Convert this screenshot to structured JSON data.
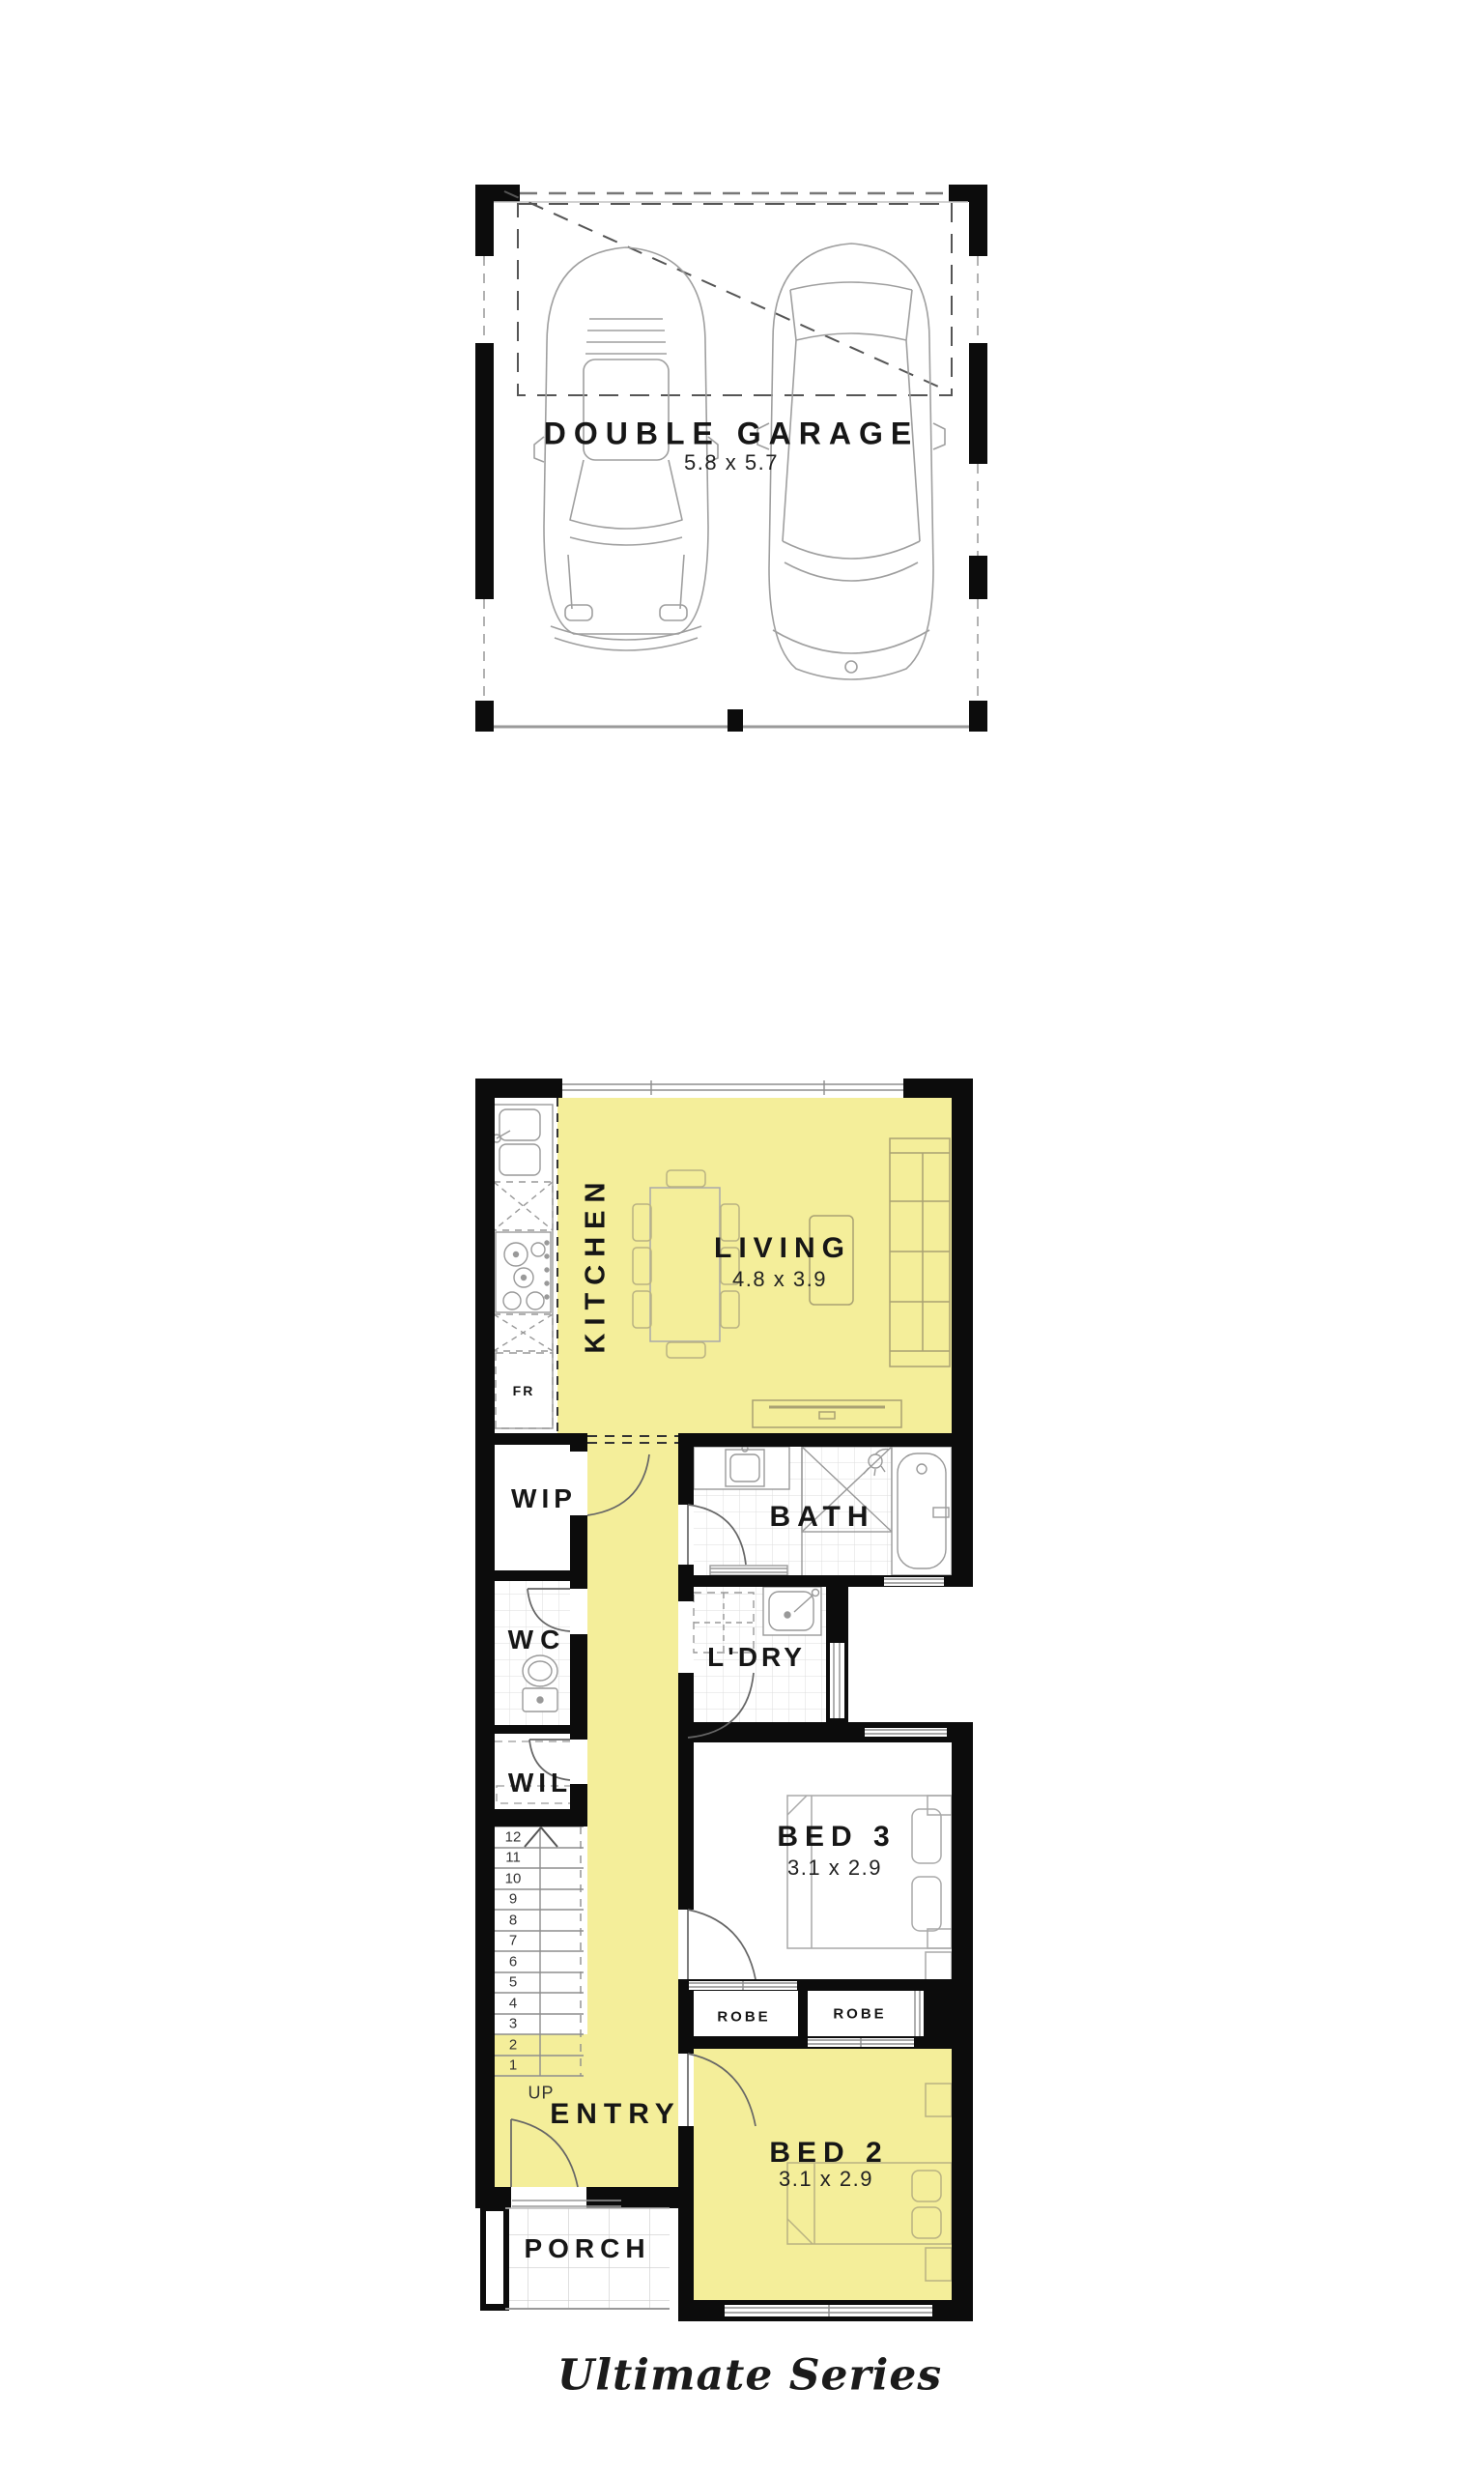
{
  "colors": {
    "highlight": "#F4EE9A",
    "wall": "#0c0c0c",
    "text": "#161616"
  },
  "garage_plan": {
    "title": "DOUBLE GARAGE",
    "dims": "5.8 x 5.7"
  },
  "ground_plan": {
    "kitchen": {
      "label": "KITCHEN"
    },
    "living": {
      "label": "LIVING",
      "dims": "4.8 x 3.9"
    },
    "fridge_label": "FR",
    "wip": {
      "label": "WIP"
    },
    "bath": {
      "label": "BATH"
    },
    "wc": {
      "label": "WC"
    },
    "ldry": {
      "label": "L'DRY"
    },
    "wil": {
      "label": "WIL"
    },
    "bed3": {
      "label": "BED 3",
      "dims": "3.1 x 2.9"
    },
    "robe1": {
      "label": "ROBE"
    },
    "robe2": {
      "label": "ROBE"
    },
    "entry": {
      "label": "ENTRY"
    },
    "bed2": {
      "label": "BED 2",
      "dims": "3.1 x 2.9"
    },
    "porch": {
      "label": "PORCH"
    },
    "stairs": {
      "up": "UP",
      "steps": [
        "12",
        "11",
        "10",
        "9",
        "8",
        "7",
        "6",
        "5",
        "4",
        "3",
        "2",
        "1"
      ]
    }
  },
  "footer": {
    "series_label": "Ultimate Series"
  }
}
